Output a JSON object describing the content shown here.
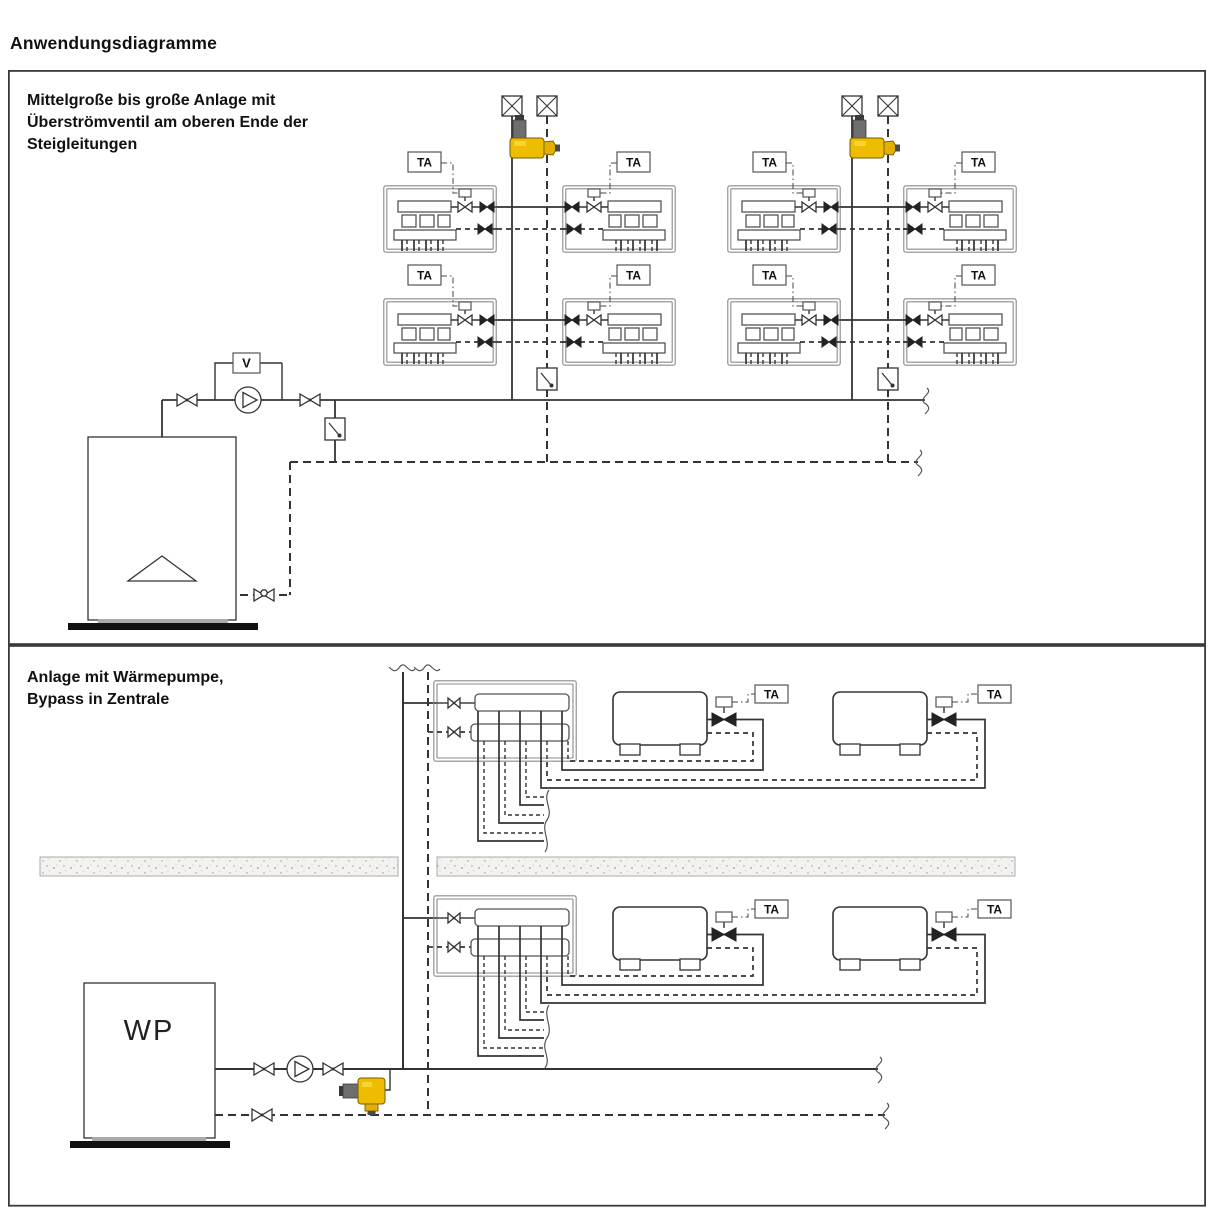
{
  "page": {
    "title": "Anwendungsdiagramme"
  },
  "panels": [
    {
      "id": "panel-1",
      "title_lines": [
        "Mittelgroße bis große Anlage mit",
        "Überströmventil am oberen Ende der",
        "Steigleitungen"
      ]
    },
    {
      "id": "panel-2",
      "title_lines": [
        "Anlage mit Wärmepumpe,",
        "Bypass in Zentrale"
      ]
    }
  ],
  "labels": {
    "thermostat_abbr": "TA",
    "flow_indicator": "V",
    "heat_pump_abbr": "WP"
  },
  "colors": {
    "line": "#333333",
    "overflow_valve_body": "#eebc00",
    "overflow_valve_cap": "#6e6e6e",
    "background": "#ffffff"
  }
}
